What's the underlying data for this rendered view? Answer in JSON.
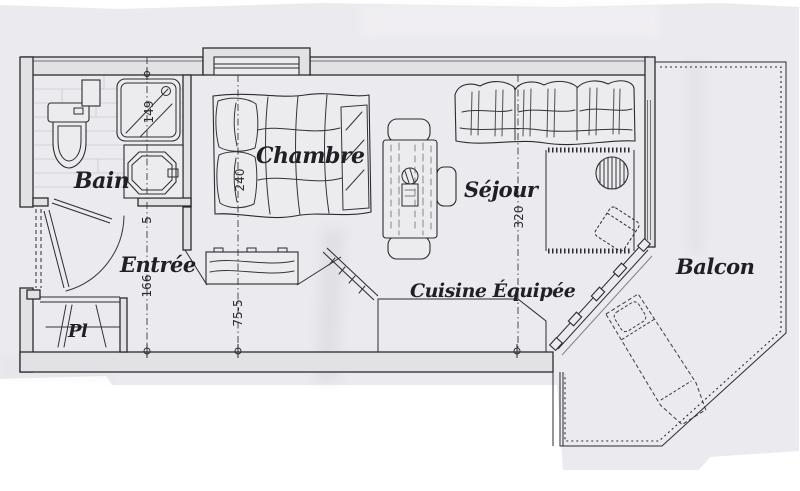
{
  "document": {
    "kind": "scanned apartment floor plan",
    "description": "Hand-drawn studio apartment plan with furnished rooms and dimension lines"
  },
  "colors": {
    "background": "#ffffff",
    "paper": "#ebeaee",
    "wall_fill": "#e2e1e4",
    "ink": "#2b2b30"
  },
  "rooms": {
    "bain": {
      "label": "Bain"
    },
    "entree": {
      "label": "Entrée"
    },
    "placard": {
      "label": "Pl"
    },
    "chambre": {
      "label": "Chambre"
    },
    "sejour": {
      "label": "Séjour"
    },
    "cuisine": {
      "label": "Cuisine Équipée"
    },
    "balcon": {
      "label": "Balcon"
    }
  },
  "dimensions": {
    "shower_width": {
      "label": "149"
    },
    "hall_gap": {
      "label": "5"
    },
    "hall_length": {
      "label": "166"
    },
    "bed_length": {
      "label": "240"
    },
    "dresser_width": {
      "label": "75-5"
    },
    "sejour_depth": {
      "label": "320"
    }
  },
  "fixtures": [
    "toilet",
    "shower-tray",
    "washbasin",
    "shelf",
    "entrance-door",
    "bathroom-door",
    "closet-rail",
    "double-bed",
    "dresser",
    "sliding-partition",
    "dining-table",
    "dining-chairs",
    "sofa",
    "rug",
    "pedestal-table",
    "armchair",
    "kitchen-counter",
    "glazed-balcony-door",
    "balcony-railing",
    "chaise-longue",
    "bay-window"
  ]
}
